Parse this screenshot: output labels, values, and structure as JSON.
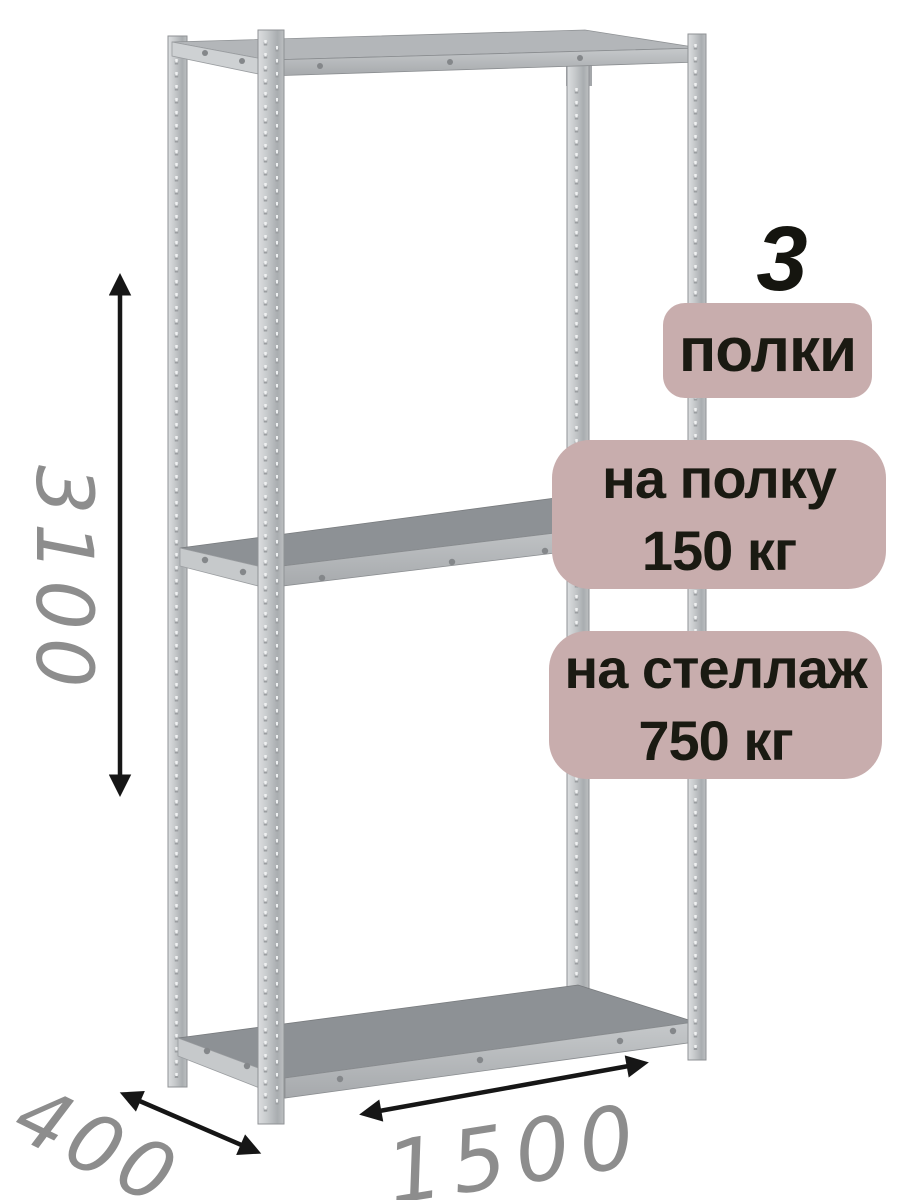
{
  "illustration": {
    "description": "metal-boltless-shelving-rack-product-diagram",
    "shelf_count": {
      "number": "3",
      "label": "полки"
    },
    "capacity": {
      "per_shelf": {
        "line1": "на полку",
        "line2": "150 кг"
      },
      "total": {
        "line1": "на стеллаж",
        "line2": "750 кг"
      }
    },
    "dimensions": {
      "height": "3100",
      "depth": "400",
      "width": "1500"
    },
    "colors": {
      "background": "#ffffff",
      "badge_background": "#c8adad",
      "badge_text": "#1a1a12",
      "dimension_text": "#8d8d8d",
      "arrow": "#161616",
      "metal_light": "#d8dadc",
      "metal_mid": "#b7babd",
      "shelf_surface": "#8d9195"
    }
  }
}
